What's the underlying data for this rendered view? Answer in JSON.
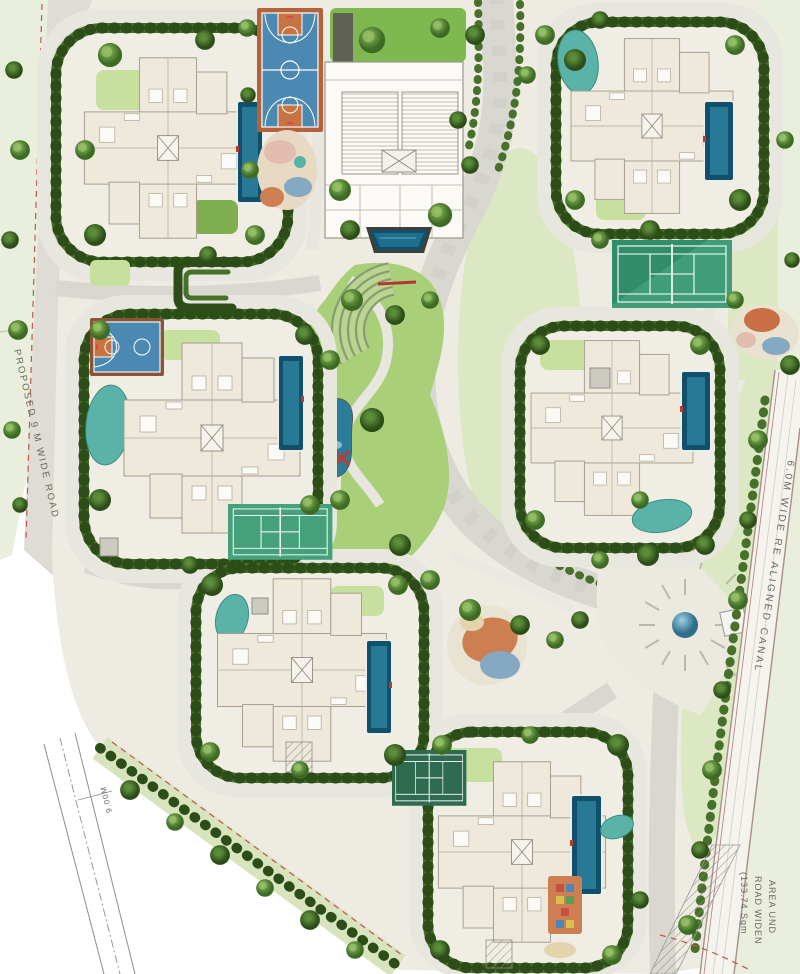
{
  "labels": {
    "left_road": "PROPOSED 9 M WIDE ROAD",
    "canal": "6.0M WIDE RE ALIGNED CANAL",
    "bottom_road_width": "9.00M",
    "area_line1": "AREA UND",
    "area_line2": "ROAD WIDEN",
    "area_line3": "(133.74 Sqm"
  },
  "palette": {
    "paper": "#ffffff",
    "ground": "#edebe2",
    "road": "#d8d8d1",
    "roadLight": "#e7e6df",
    "verge": "#dfe9cf",
    "vergeLight": "#e9efdc",
    "lawn": "#a9d078",
    "lawnLight": "#c7e09e",
    "lawnPale": "#dce8c4",
    "hedge": "#2c4d18",
    "hedgeMid": "#47702b",
    "building": "#efe9dc",
    "buildingWhite": "#fbfaf6",
    "buildingLine": "#a49d8f",
    "poolDark": "#11506b",
    "poolMid": "#2a7d9a",
    "teal": "#5ab3a8",
    "tennis": "#3f9d7a",
    "tennisShade": "#2e8766",
    "tennisDark": "#2f6b51",
    "courtBlue": "#4b89b3",
    "courtOrange": "#b5623a",
    "courtOrange2": "#c77443",
    "playOrange": "#cd7f52",
    "playBlue": "#86a9c2",
    "playPink": "#e2bcae",
    "playTan": "#e3d4ae",
    "darkPaving": "#5f6157",
    "boundaryRed": "#c0564a",
    "canalEdge": "#a98f87",
    "pathLine": "#b9b9af",
    "textGray": "#6b685f",
    "sphereBlue": "#63a7bd"
  }
}
